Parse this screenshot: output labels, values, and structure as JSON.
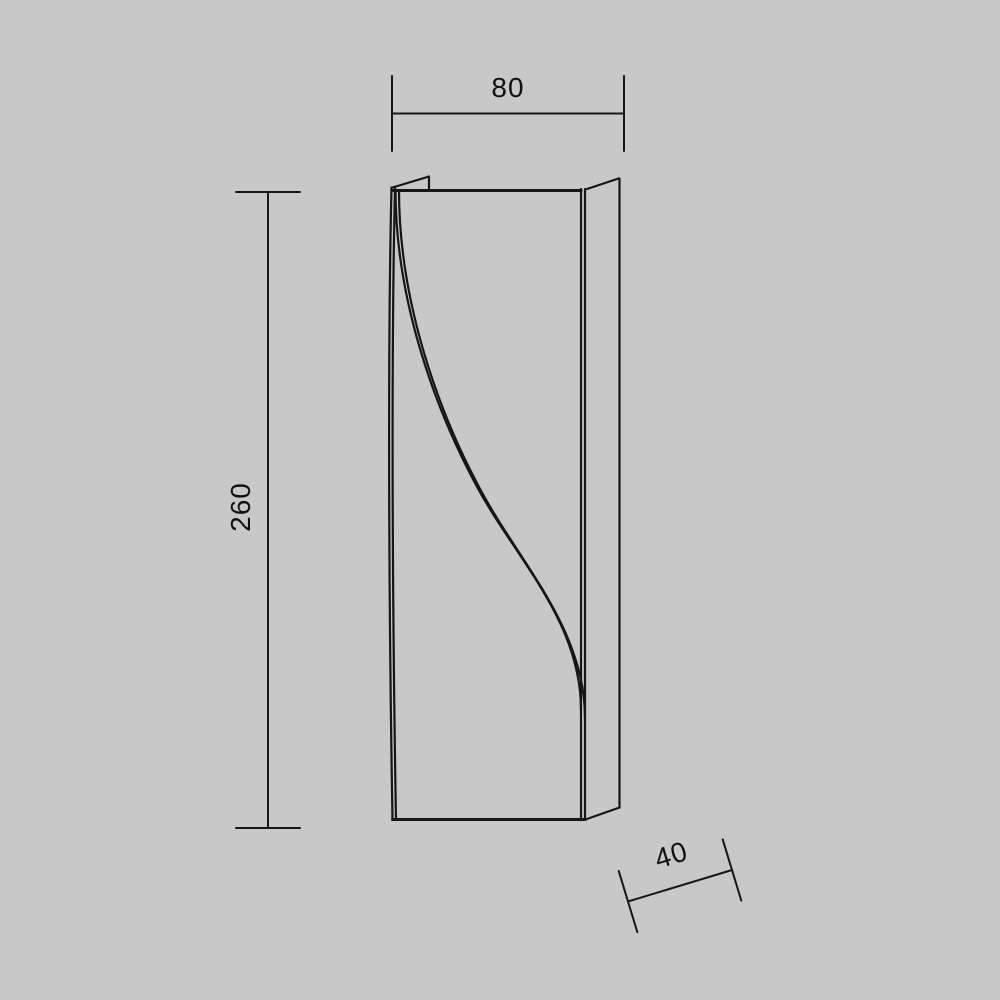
{
  "colors": {
    "background_color": "#c8c8c8",
    "line_color": "#161616",
    "text_color": "#111111"
  },
  "drawing": {
    "kind": "product dimension diagram",
    "dimensions": {
      "width": {
        "value": "80"
      },
      "height": {
        "value": "260"
      },
      "depth": {
        "value": "40"
      }
    }
  }
}
